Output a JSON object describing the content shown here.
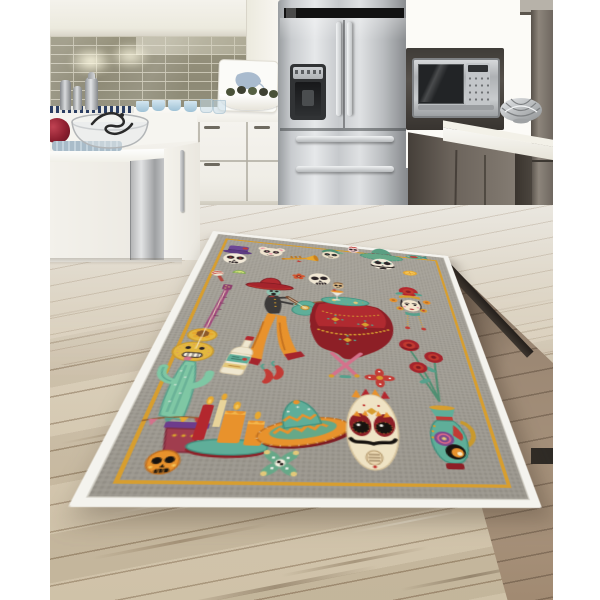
{
  "scene": {
    "type": "product-photo",
    "subject": "Day of the Dead themed washable area rug displayed on a wood floor in a modern kitchen",
    "photo_margins": "white bars left and right"
  },
  "palette": {
    "field": "#a7a39a",
    "edgeWhite": "#f4f3ee",
    "gold": "#d79e2f",
    "red": "#b3272e",
    "darkRed": "#8d1f26",
    "brightRed": "#c0392f",
    "orange": "#e8922c",
    "yellow": "#e3c87a",
    "teal": "#5fae99",
    "tealDark": "#3f8f7d",
    "green": "#66a888",
    "cream": "#f2e9d8",
    "ink": "#241f1d",
    "pink": "#d4728c",
    "purple": "#6d4796",
    "tile": "#92907c",
    "steel": "#c6c9cc",
    "woodLight": "#d3c7b2",
    "woodDark": "#8f7c6a",
    "cabinetTaupe": "#6e665e"
  },
  "kitchen": {
    "elements": [
      "white upper cabinets",
      "olive subway tile backsplash",
      "under-cabinet lights",
      "metal canisters and cocktail shaker",
      "serving board with leaf print",
      "white fruit bowl",
      "blue cups",
      "white base cabinets",
      "kitchen island with glass bowl and red teapot",
      "stainless dishwasher panel",
      "stainless french-door refrigerator with water dispenser",
      "built-in stainless microwave in dark surround",
      "taupe wood-grain tall cabinets and drawers",
      "white countertops",
      "silver wire bowl",
      "light wood plank floor"
    ]
  },
  "rug": {
    "style": "gray linen-weave field, white outer binding, thin gold line frame",
    "motifs": [
      "top-hat sugar skull",
      "maraca",
      "lime wedge",
      "bear sugar skull",
      "trumpet",
      "small marigold flower",
      "tilted cream skull",
      "green-bonnet skull",
      "small pink skull",
      "sombrero skull with mustache",
      "folk fish",
      "orange slice",
      "floating mini skull",
      "catrina with rose headdress",
      "mariachi skeleton with red sombrero and guitar",
      "draped red table with cocktail and crossed legs",
      "yellow folk guitar with sunflower",
      "tequila bottle",
      "chili peppers",
      "cross flower",
      "rose bouquet",
      "cactus in pot with banner",
      "candles on teal plate",
      "big teal-and-orange sombrero",
      "large skull mask with mustache",
      "folk pitcher vase",
      "orange skull",
      "green x-motif"
    ]
  }
}
